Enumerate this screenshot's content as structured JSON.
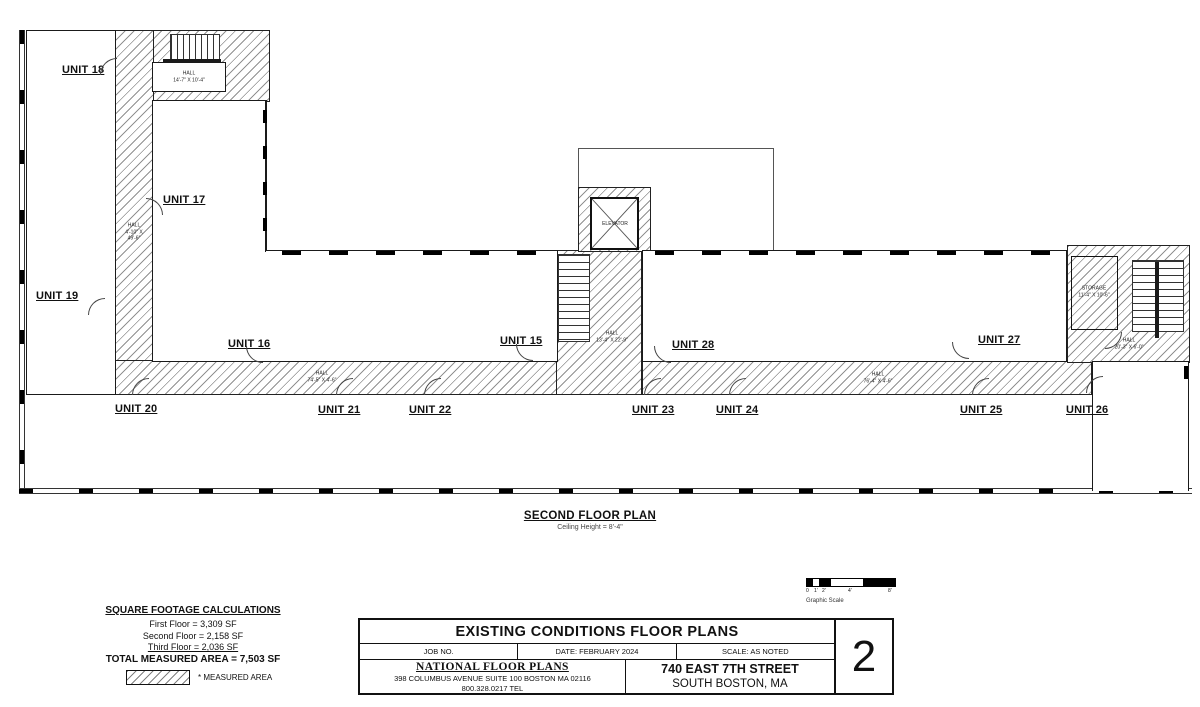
{
  "plan": {
    "title": "SECOND FLOOR PLAN",
    "subtitle": "Ceiling Height = 8'-4\"",
    "units": [
      "UNIT 18",
      "UNIT 17",
      "UNIT 19",
      "UNIT 16",
      "UNIT 15",
      "UNIT 28",
      "UNIT 27",
      "UNIT 20",
      "UNIT 21",
      "UNIT 22",
      "UNIT 23",
      "UNIT 24",
      "UNIT 25",
      "UNIT 26"
    ],
    "halls": [
      {
        "name": "HALL",
        "dims": "14'-7\" X 10'-4\""
      },
      {
        "name": "HALL",
        "dims": "4'-10\" X 49'-6\""
      },
      {
        "name": "HALL",
        "dims": "74'-5\" X 4'-6\""
      },
      {
        "name": "HALL",
        "dims": "13'-4\" X 22'-9\""
      },
      {
        "name": "HALL",
        "dims": "76'-4\" X 4'-6\""
      },
      {
        "name": "STORAGE",
        "dims": "11'-4\" X 10'-6\""
      },
      {
        "name": "HALL",
        "dims": "20'-3\" X 6'-0\""
      }
    ],
    "elevator_label": "ELEVATOR"
  },
  "legend": {
    "heading": "SQUARE FOOTAGE CALCULATIONS",
    "lines": [
      "First Floor = 3,309 SF",
      "Second Floor = 2,158 SF",
      "Third Floor = 2,036 SF"
    ],
    "total": "TOTAL MEASURED AREA = 7,503 SF",
    "note": "* MEASURED AREA"
  },
  "scalebar": {
    "ticks": [
      "0",
      "1'",
      "2'",
      "4'",
      "8'"
    ],
    "caption": "Graphic Scale"
  },
  "titleblock": {
    "title": "EXISTING CONDITIONS FLOOR PLANS",
    "job_no": "JOB NO.",
    "date": "DATE: FEBRUARY 2024",
    "scale": "SCALE: AS NOTED",
    "firm": "NATIONAL FLOOR PLANS",
    "address": "398 COLUMBUS AVENUE SUITE 100 BOSTON MA 02116",
    "phone": "800.328.0217 TEL",
    "site_line1": "740 EAST 7TH STREET",
    "site_line2": "SOUTH BOSTON, MA",
    "sheet": "2"
  }
}
